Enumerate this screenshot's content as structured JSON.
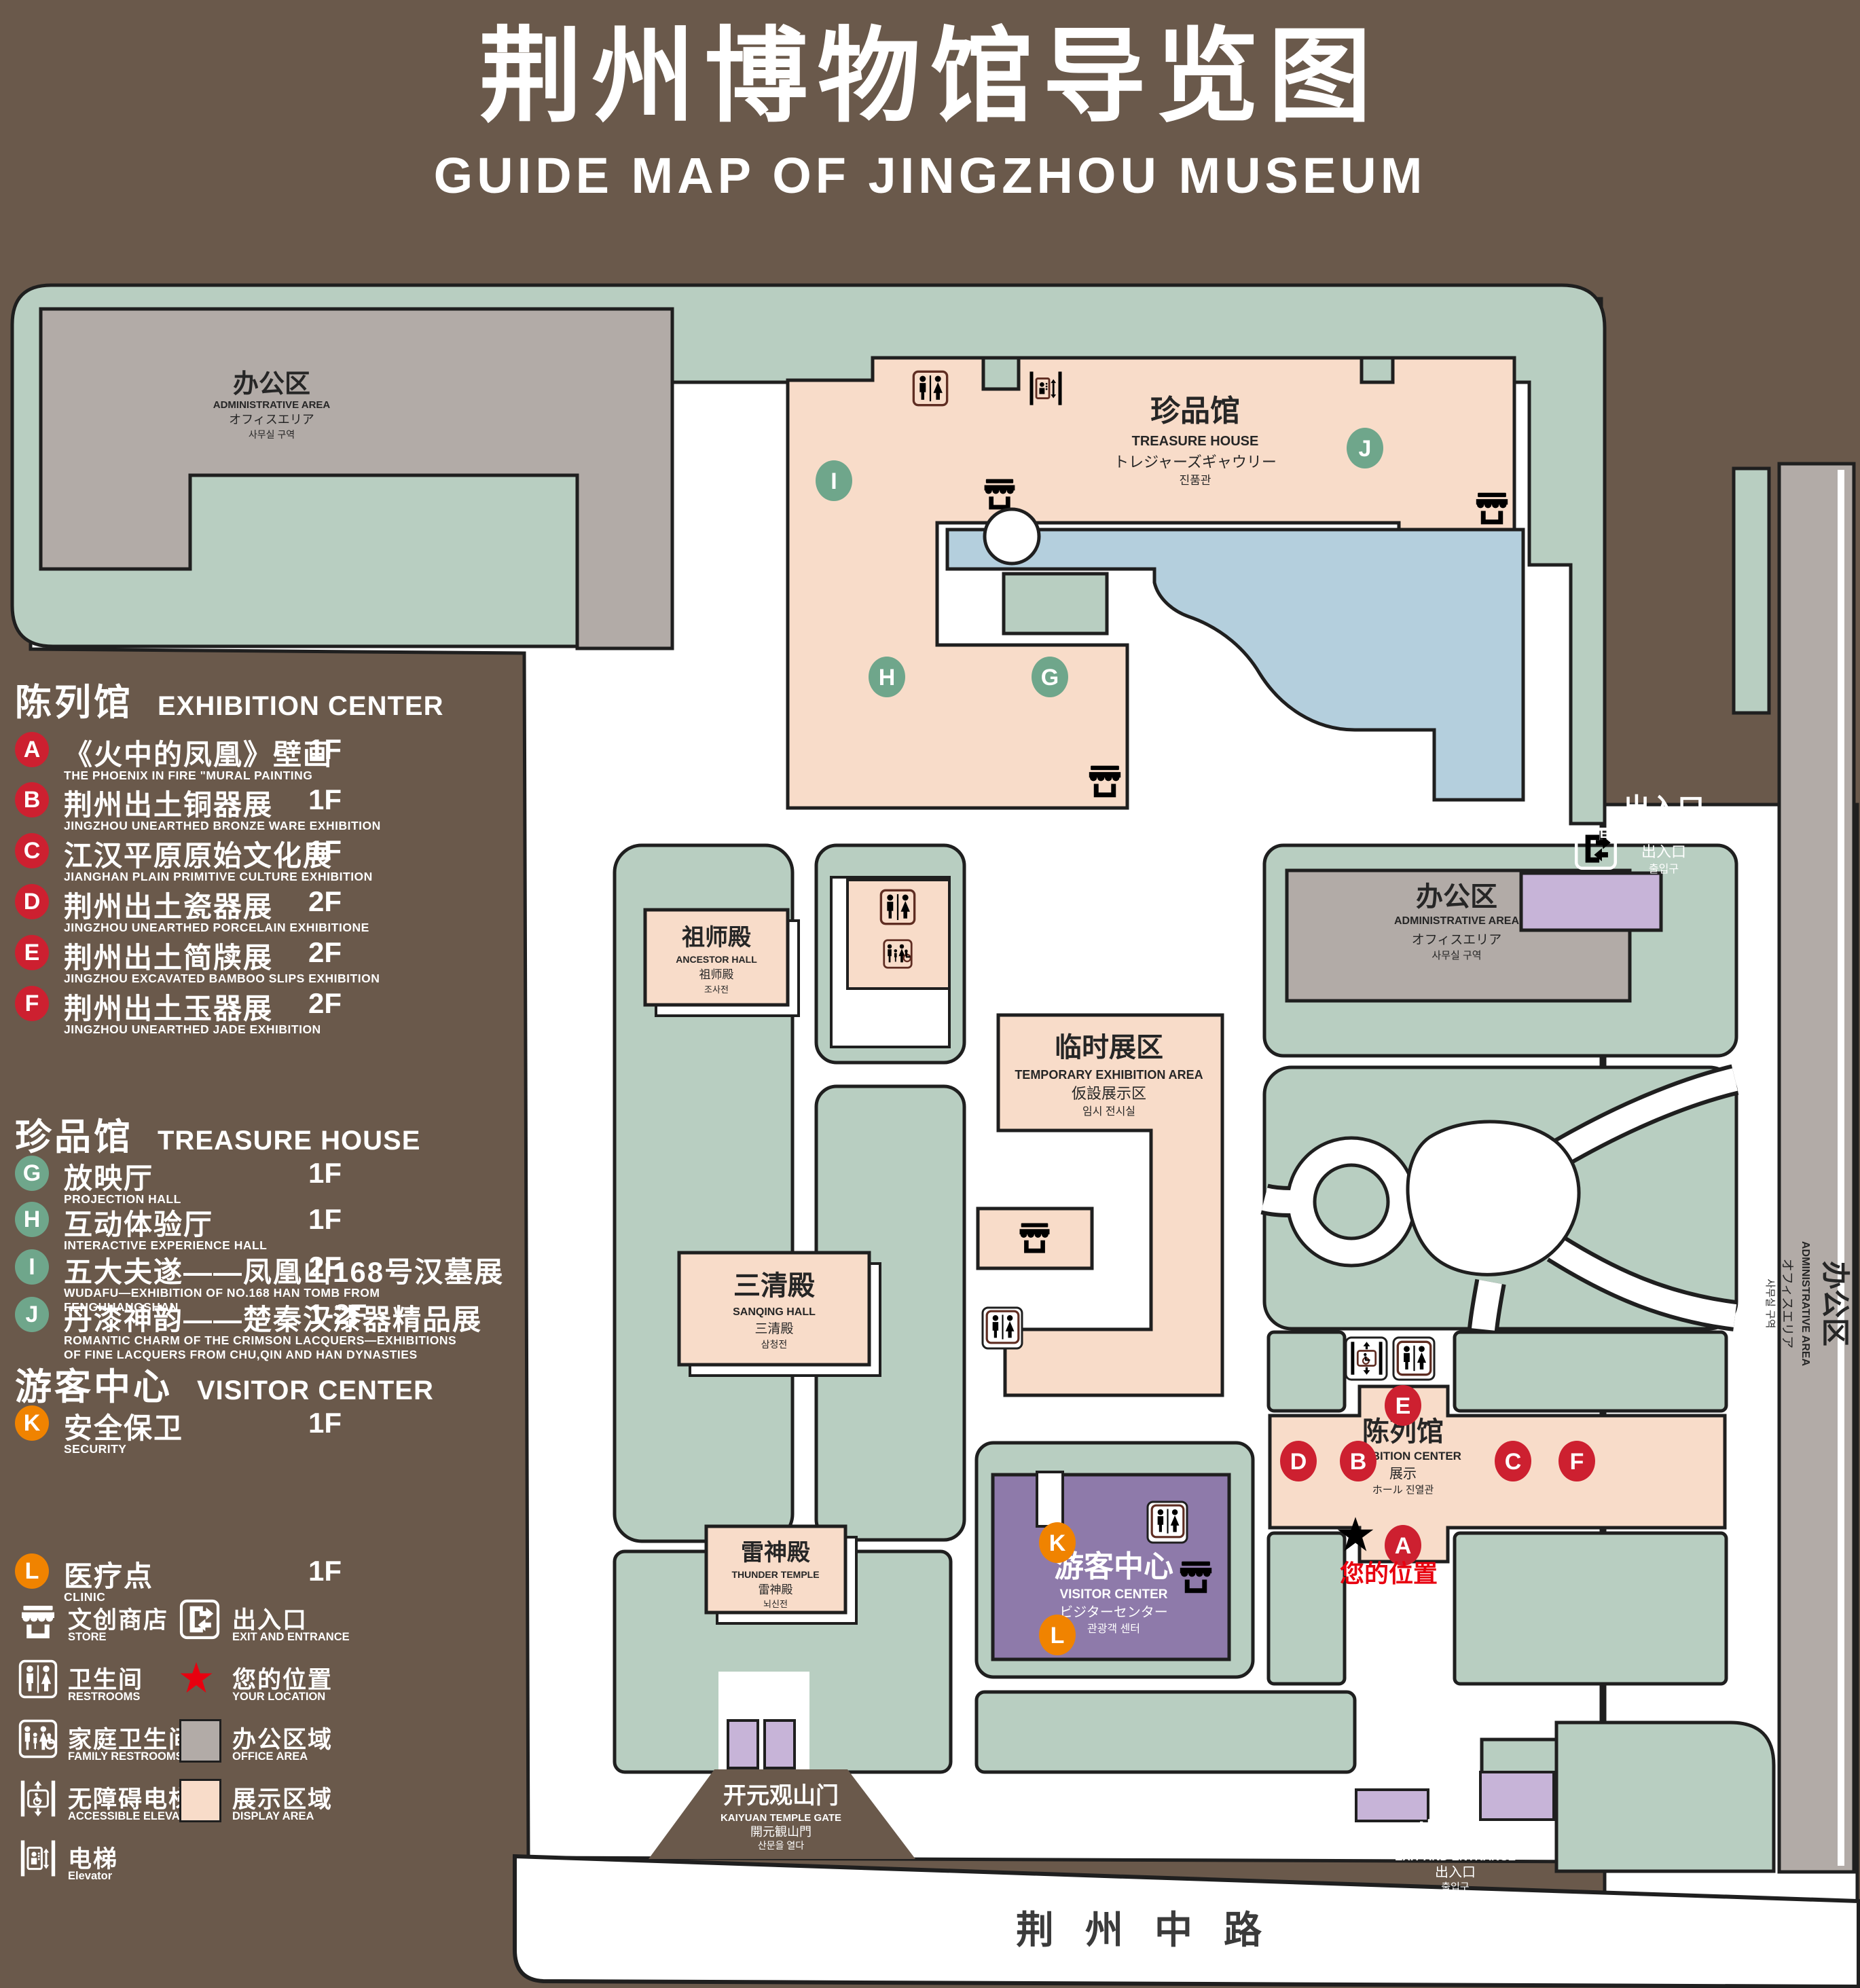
{
  "title": {
    "zh": "荆州博物馆导览图",
    "en": "GUIDE MAP OF JINGZHOU MUSEUM"
  },
  "colors": {
    "background": "#6a594b",
    "green_area": "#b8cec1",
    "display_area": "#f8dcc9",
    "office_area": "#b2aba7",
    "pond": "#b4cfdd",
    "visitor_purple": "#8e7aaa",
    "lavender": "#c7b4d8",
    "icon_maroon": "#5f2d22",
    "badge_red": "#cd2030",
    "badge_green": "#6fa68b",
    "badge_orange": "#f08300",
    "location_red": "#e8000f"
  },
  "legend": {
    "sections": [
      {
        "zh": "陈列馆",
        "en": "EXHIBITION CENTER",
        "items": [
          {
            "key": "A",
            "zh": "《火中的凤凰》壁画",
            "en": "THE PHOENIX IN FIRE \"MURAL PAINTING",
            "floor": "1F"
          },
          {
            "key": "B",
            "zh": "荆州出土铜器展",
            "en": "JINGZHOU UNEARTHED BRONZE WARE EXHIBITION",
            "floor": "1F"
          },
          {
            "key": "C",
            "zh": "江汉平原原始文化展",
            "en": "JIANGHAN PLAIN PRIMITIVE CULTURE EXHIBITION",
            "floor": "1F"
          },
          {
            "key": "D",
            "zh": "荆州出土瓷器展",
            "en": "JINGZHOU UNEARTHED PORCELAIN EXHIBITIONE",
            "floor": "2F"
          },
          {
            "key": "E",
            "zh": "荆州出土简牍展",
            "en": "JINGZHOU EXCAVATED BAMBOO SLIPS EXHIBITION",
            "floor": "2F"
          },
          {
            "key": "F",
            "zh": "荆州出土玉器展",
            "en": "JINGZHOU UNEARTHED JADE EXHIBITION",
            "floor": "2F"
          }
        ]
      },
      {
        "zh": "珍品馆",
        "en": "TREASURE HOUSE",
        "items": [
          {
            "key": "G",
            "zh": "放映厅",
            "en": "PROJECTION HALL",
            "floor": "1F"
          },
          {
            "key": "H",
            "zh": "互动体验厅",
            "en": "INTERACTIVE EXPERIENCE HALL",
            "floor": "1F"
          },
          {
            "key": "I",
            "zh": "五大夫遂——凤凰山168号汉墓展",
            "en": "WUDAFU—EXHIBITION OF NO.168 HAN TOMB FROM FENGHUANGSHAN",
            "floor": "2F"
          },
          {
            "key": "J",
            "zh": "丹漆神韵——楚秦汉漆器精品展",
            "en": "ROMANTIC CHARM OF THE CRIMSON LACQUERS—EXHIBITIONS\nOF FINE LACQUERS FROM CHU,QIN AND HAN DYNASTIES",
            "floor": "1-2F"
          }
        ]
      },
      {
        "zh": "游客中心",
        "en": "VISITOR CENTER",
        "items": [
          {
            "key": "K",
            "zh": "安全保卫",
            "en": "SECURITY",
            "floor": "1F"
          },
          {
            "key": "L",
            "zh": "医疗点",
            "en": "CLINIC",
            "floor": "1F"
          }
        ]
      }
    ],
    "symbols": [
      {
        "icon": "store-icon",
        "zh": "文创商店",
        "en": "STORE"
      },
      {
        "icon": "exit-icon",
        "zh": "出入口",
        "en": "EXIT AND ENTRANCE"
      },
      {
        "icon": "restroom-icon",
        "zh": "卫生间",
        "en": "RESTROOMS"
      },
      {
        "icon": "location-star-icon",
        "zh": "您的位置",
        "en": "YOUR LOCATION"
      },
      {
        "icon": "family-restroom-icon",
        "zh": "家庭卫生间",
        "en": "FAMILY RESTROOMS"
      },
      {
        "icon": "office-area-swatch",
        "zh": "办公区域",
        "en": "OFFICE AREA"
      },
      {
        "icon": "accessible-elevator-icon",
        "zh": "无障碍电梯",
        "en": "ACCESSIBLE ELEVATOR"
      },
      {
        "icon": "display-area-swatch",
        "zh": "展示区域",
        "en": "DISPLAY AREA"
      },
      {
        "icon": "elevator-icon",
        "zh": "电梯",
        "en": "Elevator"
      }
    ]
  },
  "map": {
    "buildings": {
      "admin": {
        "lines": [
          "办公区",
          "ADMINISTRATIVE AREA",
          "オフィスエリア",
          "사무실 구역"
        ]
      },
      "treasure": {
        "lines": [
          "珍品馆",
          "TREASURE HOUSE",
          "トレジャーズギャウリー",
          "진품관"
        ]
      },
      "ancestor": {
        "lines": [
          "祖师殿",
          "ANCESTOR HALL",
          "祖师殿",
          "조사전"
        ]
      },
      "sanqing": {
        "lines": [
          "三清殿",
          "SANQING HALL",
          "三清殿",
          "삼청전"
        ]
      },
      "thunder": {
        "lines": [
          "雷神殿",
          "THUNDER TEMPLE",
          "雷神殿",
          "뇌신전"
        ]
      },
      "temporary": {
        "lines": [
          "临时展区",
          "TEMPORARY EXHIBITION AREA",
          "仮設展示区",
          "임시 전시실"
        ]
      },
      "visitor": {
        "lines": [
          "游客中心",
          "VISITOR CENTER",
          "ビジターセンター",
          "관광객 센터"
        ]
      },
      "exhibition": {
        "lines": [
          "陈列馆",
          "EXHIBITION CENTER",
          "展示",
          "ホール 진열관"
        ]
      },
      "gate": {
        "lines": [
          "开元观山门",
          "KAIYUAN TEMPLE GATE",
          "開元観山門",
          "산문을 열다"
        ]
      },
      "exit": {
        "lines": [
          "出入口",
          "EXIT AND ENTRANCE",
          "出入口",
          "출입구"
        ]
      }
    },
    "markers": {
      "A": "A",
      "B": "B",
      "C": "C",
      "D": "D",
      "E": "E",
      "F": "F",
      "G": "G",
      "H": "H",
      "I": "I",
      "J": "J",
      "K": "K",
      "L": "L"
    },
    "your_location": "您的位置",
    "road": "荆州中路"
  }
}
